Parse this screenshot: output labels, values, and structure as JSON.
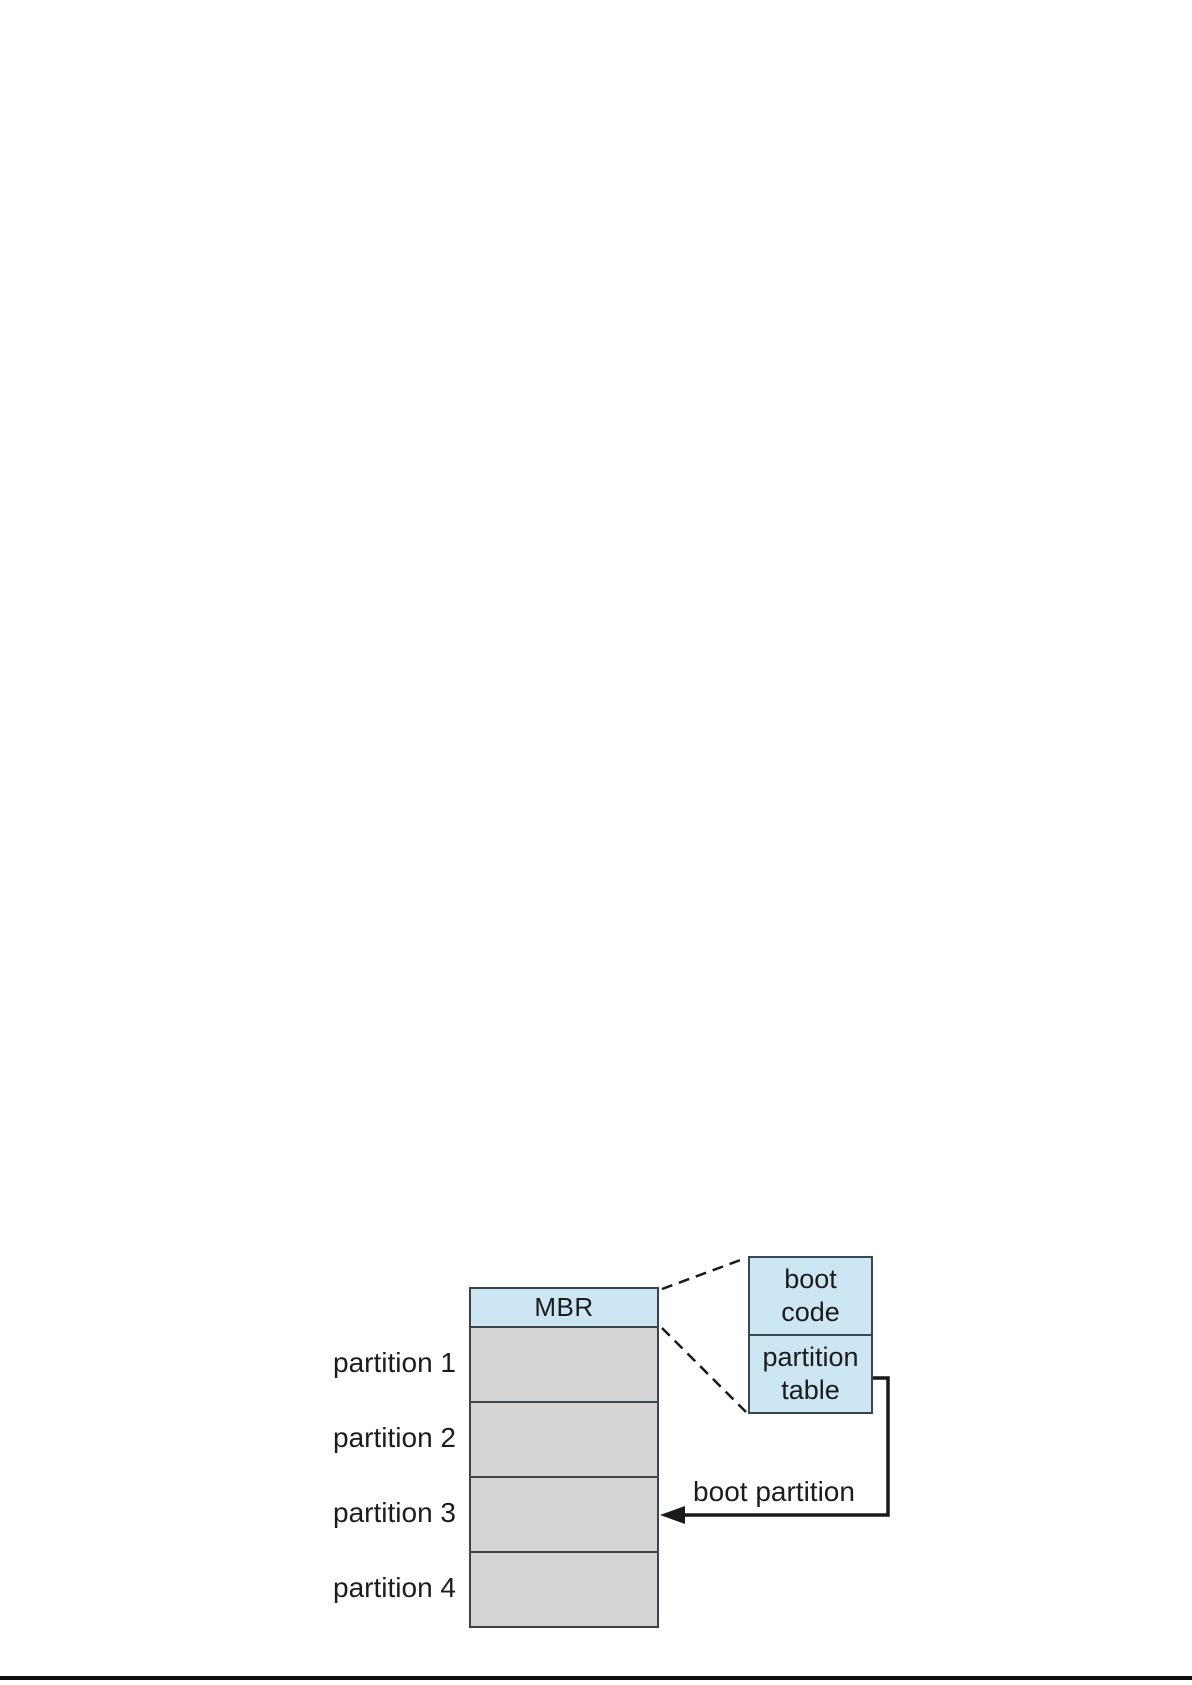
{
  "figure": {
    "disk": {
      "mbr_label": "MBR",
      "partition_labels": [
        "partition 1",
        "partition 2",
        "partition 3",
        "partition 4"
      ]
    },
    "mbr_detail": {
      "boot_code_line1": "boot",
      "boot_code_line2": "code",
      "partition_table_line1": "partition",
      "partition_table_line2": "table"
    },
    "arrow_label": "boot partition",
    "colors": {
      "box_fill_blue": "#cde6f3",
      "box_fill_gray": "#d4d4d4",
      "border_dark": "#3c4449",
      "line_black": "#1a1a1a"
    }
  }
}
